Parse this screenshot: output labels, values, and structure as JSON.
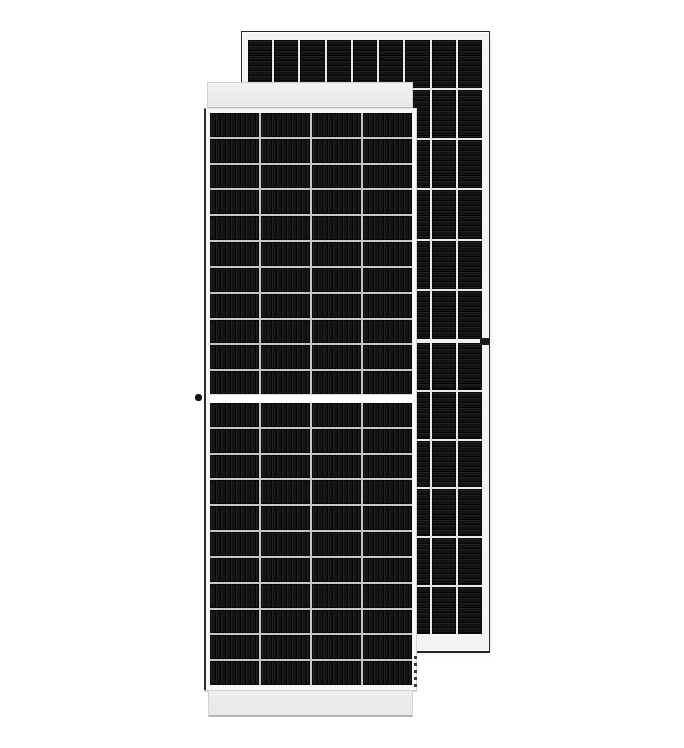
{
  "scene": {
    "type": "product-photo",
    "subject": "Two framed monocrystalline half-cut solar panels on a white background; front (glass-side) panel overlapping a taller rear (backsheet-side) panel",
    "background_color": "#ffffff"
  },
  "front_panel": {
    "label": "solar-panel-front-view",
    "view": "front glass side, half-cut cell layout with horizontal center divider",
    "columns": 4,
    "rows_top_half": 11,
    "rows_bottom_half": 11,
    "cell_stripe_direction": "vertical",
    "cell_color": "#161616",
    "cell_stripe_color": "#050505",
    "grid_line_color": "#c3c7c8",
    "center_gap_color": "#ffffff",
    "frame_band_color": "#e7e9e9",
    "dark_outline_color": "#2e2e2e",
    "grounding_dot_color": "#0d0d0d"
  },
  "back_panel": {
    "label": "solar-panel-rear-view",
    "view": "rear backsheet side with horizontal cell ribbons and center divider",
    "columns": 9,
    "rows_top_half": 6,
    "rows_bottom_half": 6,
    "cell_stripe_direction": "horizontal",
    "cell_color": "#131313",
    "cell_stripe_color": "#050505",
    "grid_line_color": "#e7e9e9",
    "frame_color": "#f2f3f3",
    "outline_color": "#262626",
    "grounding_mark_color": "#1a1a1a"
  }
}
